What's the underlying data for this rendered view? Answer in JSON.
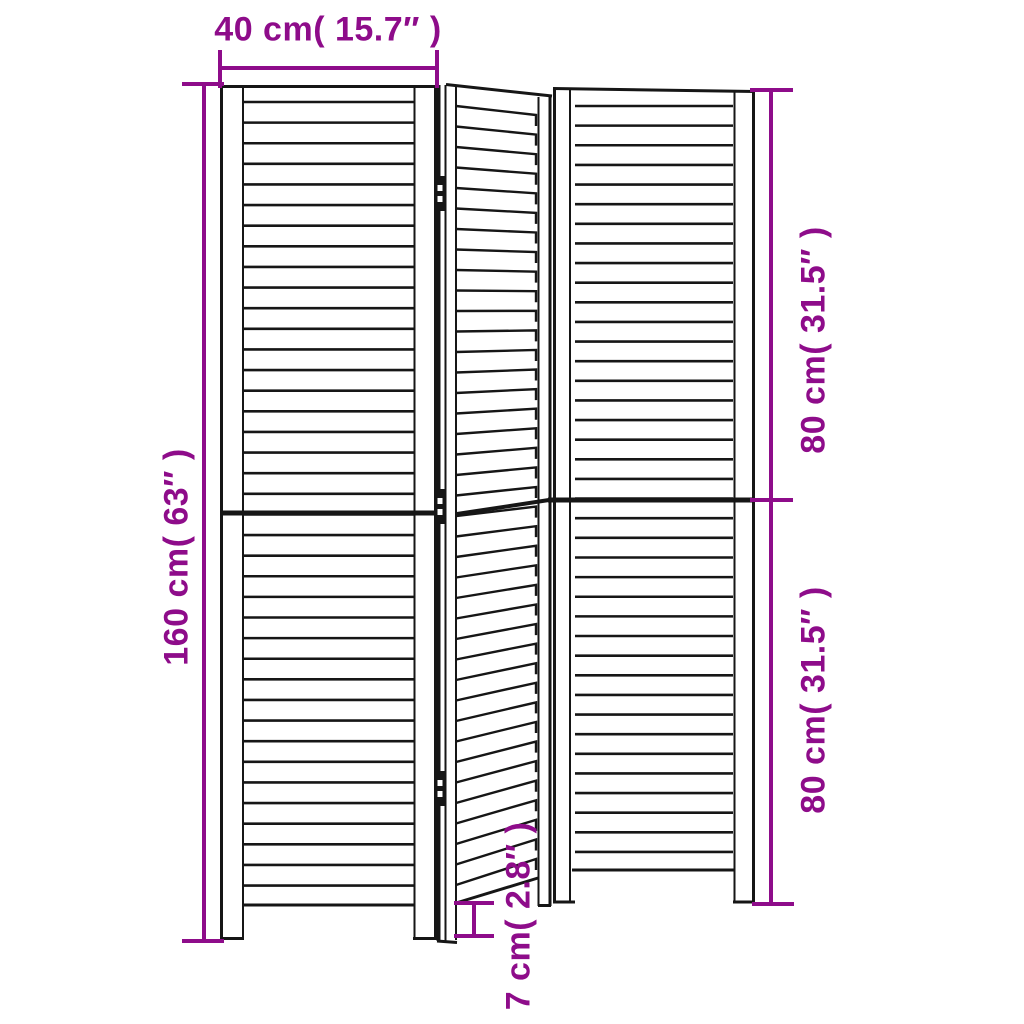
{
  "diagram": {
    "labels": {
      "width": "40 cm( 15.7″ )",
      "total_height": "160 cm( 63″ )",
      "upper_section": "80 cm( 31.5″ )",
      "lower_section": "80 cm( 31.5″ )",
      "foot": "7 cm( 2.8″ )"
    },
    "colors": {
      "dimension": "#8e0c8a",
      "line": "#161616",
      "background": "#ffffff"
    }
  }
}
